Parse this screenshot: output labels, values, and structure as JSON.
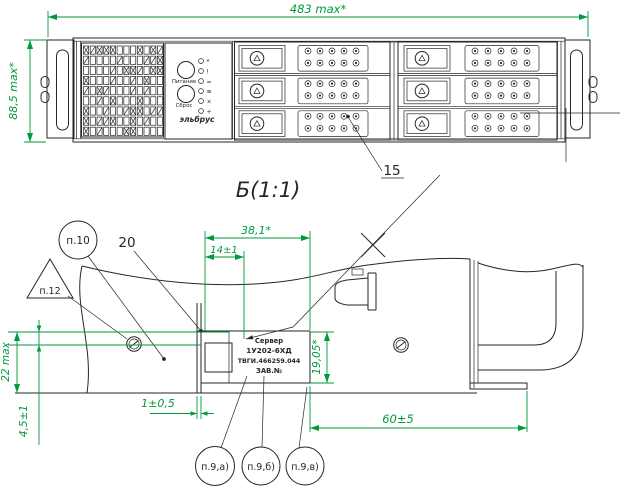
{
  "colors": {
    "line": "#262626",
    "dimension": "#009a3c",
    "background": "#ffffff"
  },
  "front_view": {
    "dim_width": "483 max*",
    "dim_height": "88,5 max*",
    "callout_drive_holes": "15",
    "control_panel": {
      "power_button_label": "Питание",
      "reset_button_label": "Сброс",
      "brand_label": "эльбрус",
      "led_icon_glyphs": [
        "*",
        "!",
        "=",
        "≡",
        "×",
        "+"
      ]
    }
  },
  "detail_view": {
    "title": "Б(1:1)",
    "dim_overall_width": "38,1*",
    "dim_left_width": "14±1",
    "dim_height": "22 max",
    "dim_flange": "4,5±1",
    "dim_gap": "1±0,5",
    "dim_depth": "60±5",
    "dim_label_height": "19,05*",
    "callout_20": "20",
    "callout_p10": "п.10",
    "callout_p12": "п.12",
    "callout_p9a": "п.9,а)",
    "callout_p9b": "п.9,б)",
    "callout_p9c": "п.9,в)",
    "nameplate": {
      "line1": "Сервер",
      "line2": "1У202-6ХД",
      "line3": "ТВГИ.466259.044",
      "line4": "ЗАВ.№"
    }
  }
}
